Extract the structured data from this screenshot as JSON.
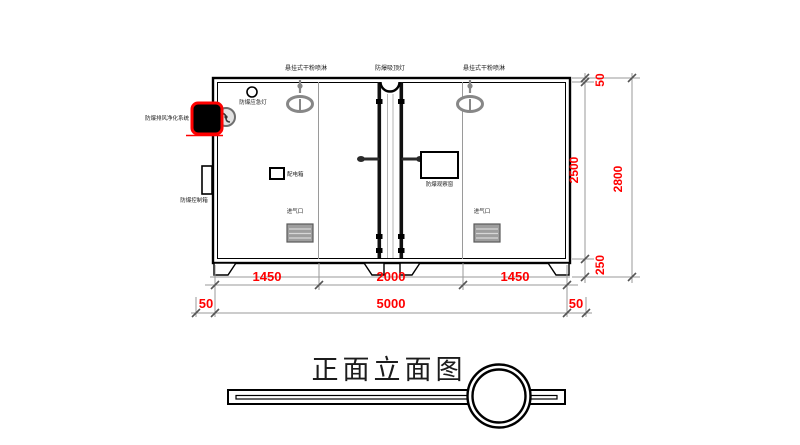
{
  "drawing": {
    "title": "正面立面图",
    "labels": {
      "sprinkler_left": "悬挂式干粉喷淋",
      "ceiling_light": "防爆吸顶灯",
      "sprinkler_right": "悬挂式干粉喷淋",
      "emergency_light": "防爆应急灯",
      "purge_system": "防爆排风净化系统",
      "control_box": "防爆控制箱",
      "distribution_box": "配电箱",
      "observation_window": "防爆观察窗",
      "air_inlet_left": "进气口",
      "air_inlet_right": "进气口"
    },
    "dimensions": {
      "bottom_segments": [
        "1450",
        "2000",
        "1450"
      ],
      "bottom_left_offset": "50",
      "bottom_total": "5000",
      "bottom_right_offset": "50",
      "right_top": "50",
      "right_middle": "2500",
      "right_bottom": "250",
      "right_overall": "2800"
    },
    "colors": {
      "dimension_text": "#ff0000",
      "highlight_border": "#ff0000",
      "line": "#000000",
      "secondary_line": "#9a9a9a"
    }
  }
}
